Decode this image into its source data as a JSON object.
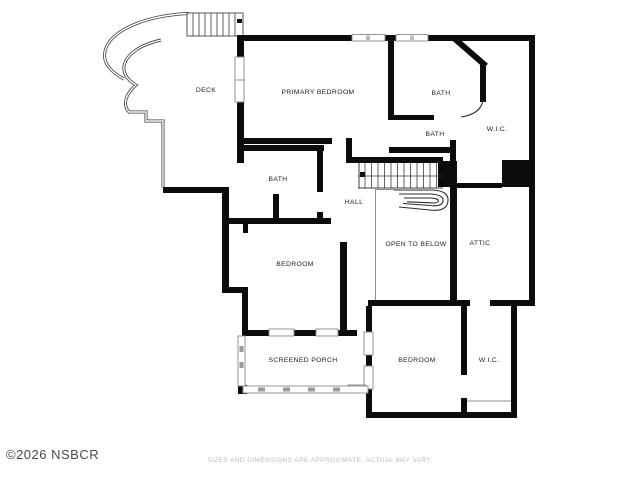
{
  "plan": {
    "type": "floor-plan",
    "rooms": [
      {
        "label": "DECK"
      },
      {
        "label": "PRIMARY BEDROOM"
      },
      {
        "label": "BATH"
      },
      {
        "label": "W.I.C."
      },
      {
        "label": "BATH"
      },
      {
        "label": "BATH"
      },
      {
        "label": "HALL"
      },
      {
        "label": "OPEN TO BELOW"
      },
      {
        "label": "ATTIC"
      },
      {
        "label": "BEDROOM"
      },
      {
        "label": "SCREENED PORCH"
      },
      {
        "label": "BEDROOM"
      },
      {
        "label": "W.I.C."
      }
    ]
  },
  "footer": {
    "copyright": "©2026 NSBCR",
    "disclaimer": "SIZES AND DIMENSIONS ARE APPROXIMATE, ACTUAL MAY VARY."
  },
  "colors": {
    "wall": "#0c0c0c",
    "thin_line": "#3c3c3c",
    "window_stroke": "#8a8a8a",
    "label": "#222222",
    "copyright": "#4a4a4a",
    "disclaimer": "#bdbdbd"
  }
}
